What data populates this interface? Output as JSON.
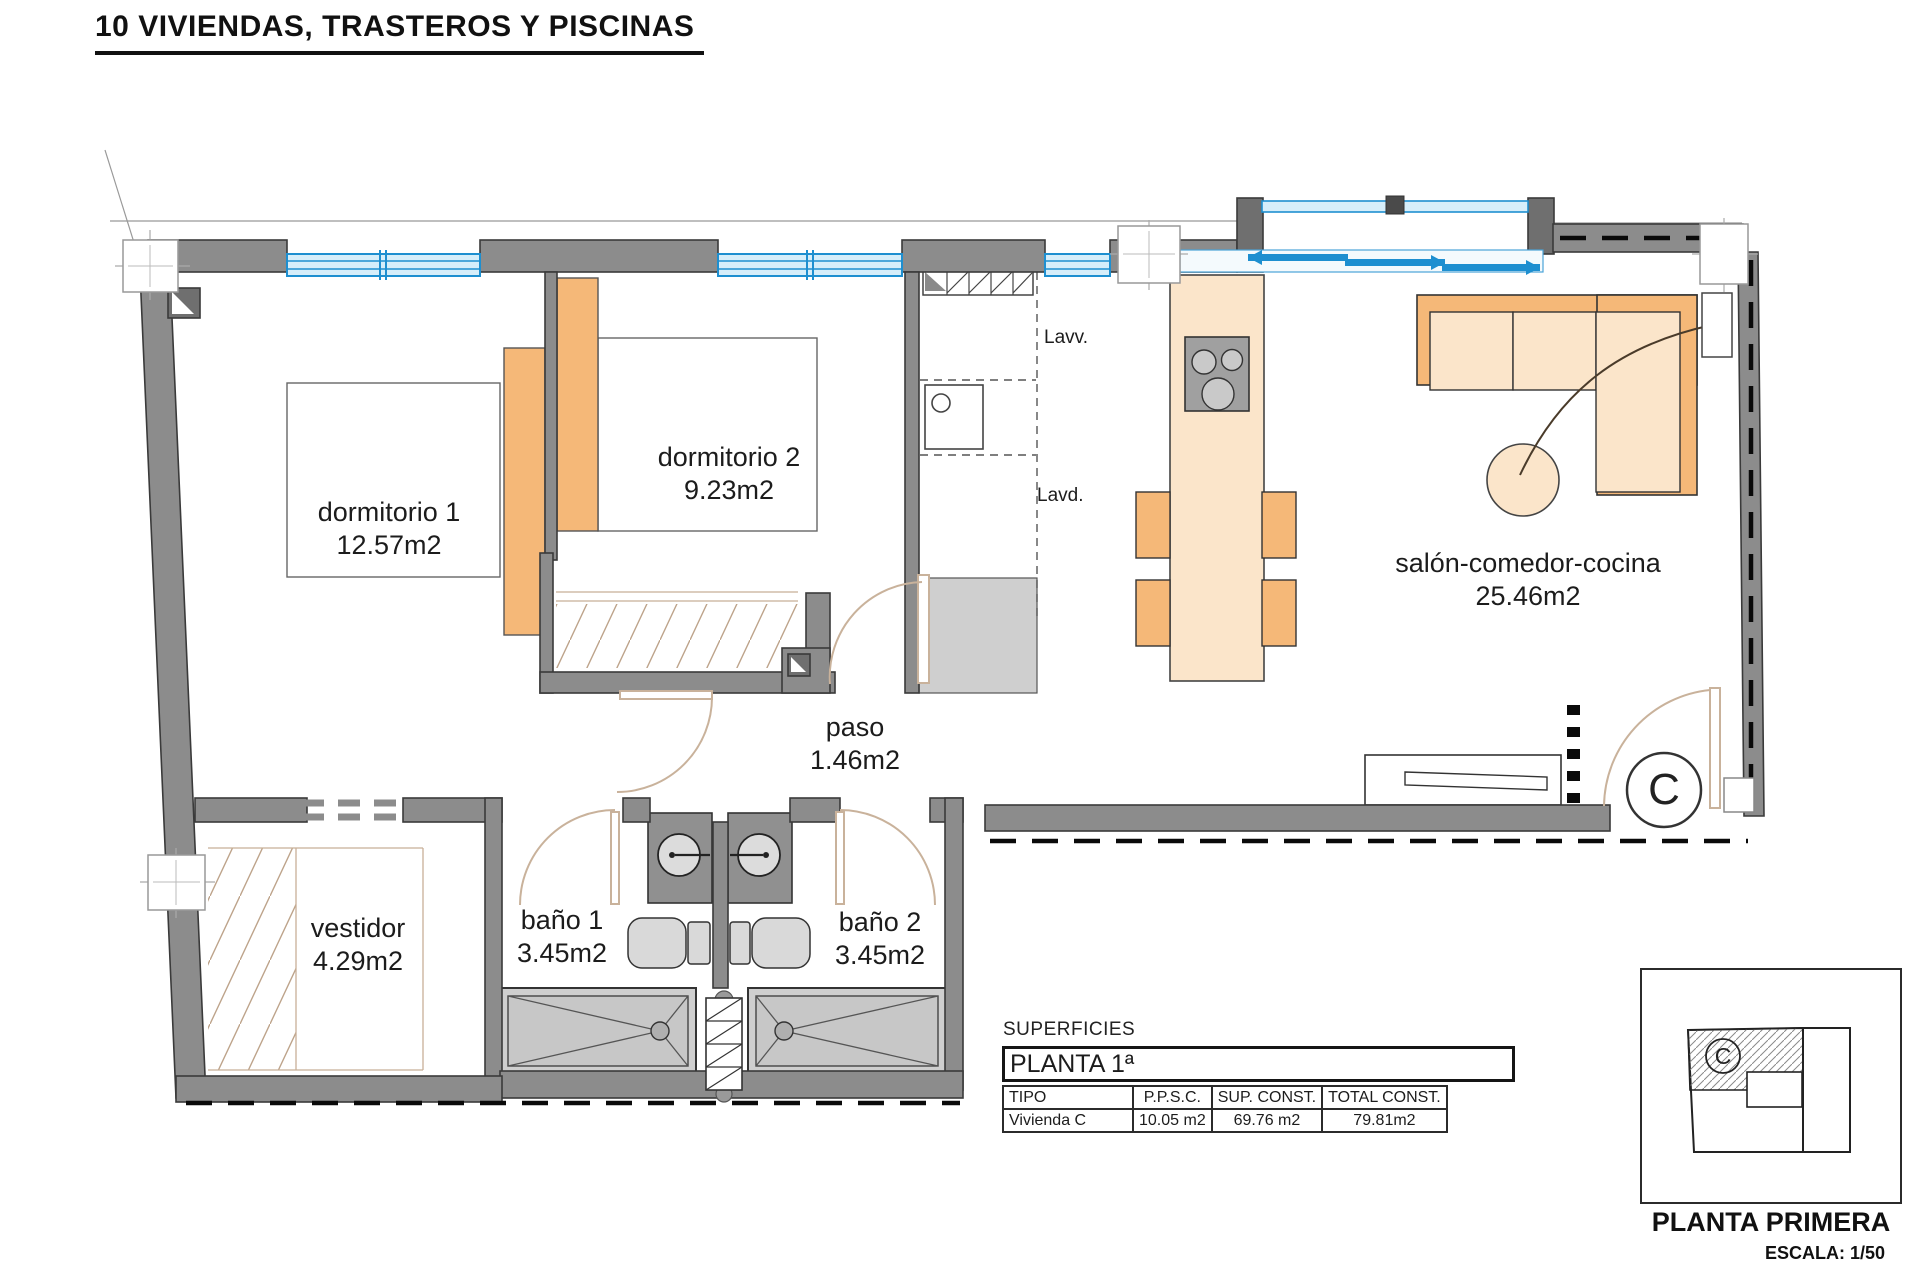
{
  "title": "10 VIVIENDAS, TRASTEROS Y PISCINAS",
  "rooms": {
    "dormitorio1": {
      "label": "dormitorio 1",
      "area": "12.57m2"
    },
    "dormitorio2": {
      "label": "dormitorio 2",
      "area": "9.23m2"
    },
    "salon": {
      "label": "salón-comedor-cocina",
      "area": "25.46m2"
    },
    "paso": {
      "label": "paso",
      "area": "1.46m2"
    },
    "vestidor": {
      "label": "vestidor",
      "area": "4.29m2"
    },
    "bano1": {
      "label": "baño 1",
      "area": "3.45m2"
    },
    "bano2": {
      "label": "baño 2",
      "area": "3.45m2"
    }
  },
  "appliances": {
    "lavv": "Lavv.",
    "lavd": "Lavd."
  },
  "unit": {
    "letter": "C"
  },
  "surfaces": {
    "heading": "SUPERFICIES",
    "floor": "PLANTA 1ª",
    "table": {
      "headers": [
        "TIPO",
        "P.P.S.C.",
        "SUP. CONST.",
        "TOTAL CONST."
      ],
      "row": [
        "Vivienda C",
        "10.05 m2",
        "69.76 m2",
        "79.81m2"
      ]
    }
  },
  "keyplan": {
    "letter": "C",
    "title": "PLANTA PRIMERA",
    "scale": "ESCALA: 1/50"
  },
  "colors": {
    "wall": "#8C8C8C",
    "wall_dark": "#6F6F6F",
    "window_blue": "#1E8FD0",
    "window_fill": "#D6EEFA",
    "furniture_orange": "#F5B878",
    "furniture_peach": "#FBE5CA",
    "fixture_gray": "#CFCFCF",
    "door_arc": "#C9B29B"
  }
}
